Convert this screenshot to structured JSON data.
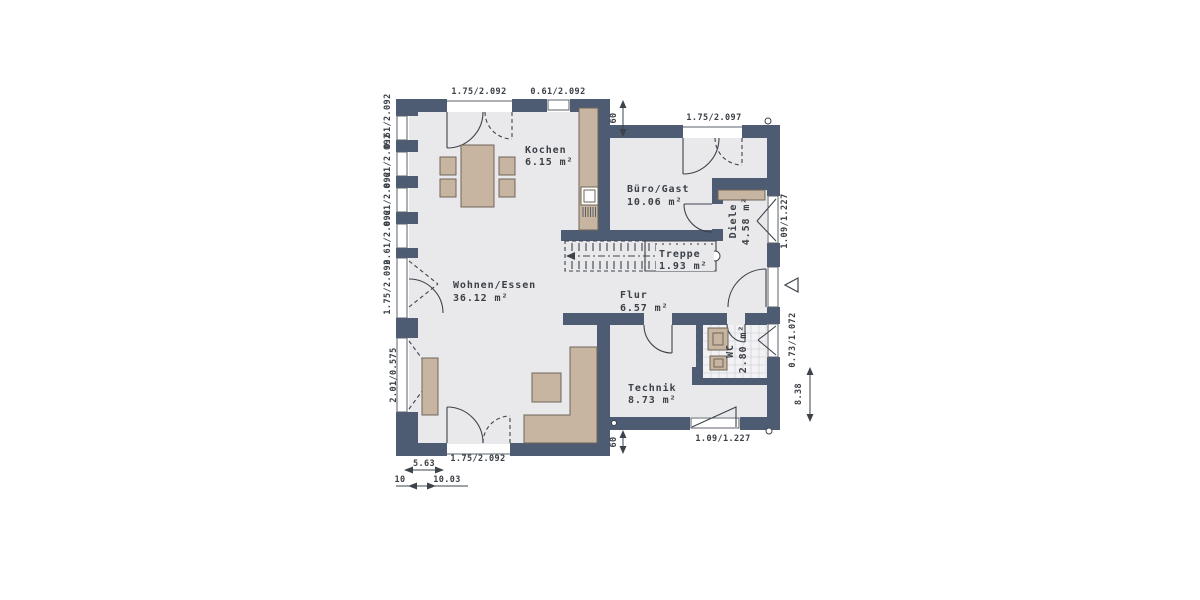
{
  "plan": {
    "type": "floor-plan",
    "rooms": {
      "kochen": {
        "name": "Kochen",
        "area": "6.15 m²"
      },
      "buero_gast": {
        "name": "Büro/Gast",
        "area": "10.06 m²"
      },
      "wohnen_essen": {
        "name": "Wohnen/Essen",
        "area": "36.12 m²"
      },
      "flur": {
        "name": "Flur",
        "area": "6.57 m²"
      },
      "treppe": {
        "name": "Treppe",
        "area": "1.93 m²"
      },
      "diele": {
        "name": "Diele",
        "area": "4.58 m²"
      },
      "wc": {
        "name": "WC",
        "area": "2.80 m²"
      },
      "technik": {
        "name": "Technik",
        "area": "8.73 m²"
      }
    },
    "dimensions": {
      "top_door": "1.75/2.092",
      "top_window": "0.61/2.092",
      "buero_door": "1.75/2.097",
      "wall_offset_top": "60",
      "wall_offset_bottom": "60",
      "left_windows": [
        "0.61/2.092",
        "0.61/2.092",
        "0.61/2.092",
        "0.61/2.092"
      ],
      "left_door": "1.75/2.092",
      "left_low_window": "2.01/0.575",
      "bottom_door": "1.75/2.092",
      "technik_window": "1.09/1.227",
      "diele_window": "1.09/1.227",
      "wc_window": "0.73/1.072",
      "height_total": "8.38",
      "width_partial": "5.63",
      "width_tick": "10",
      "width_partial2": "10.03"
    },
    "colors": {
      "wall": "#4e5c73",
      "floor": "#e9e9ec",
      "tile_floor": "#f2f2f5",
      "furniture": "#c8b5a1",
      "line": "#3d434b"
    }
  }
}
